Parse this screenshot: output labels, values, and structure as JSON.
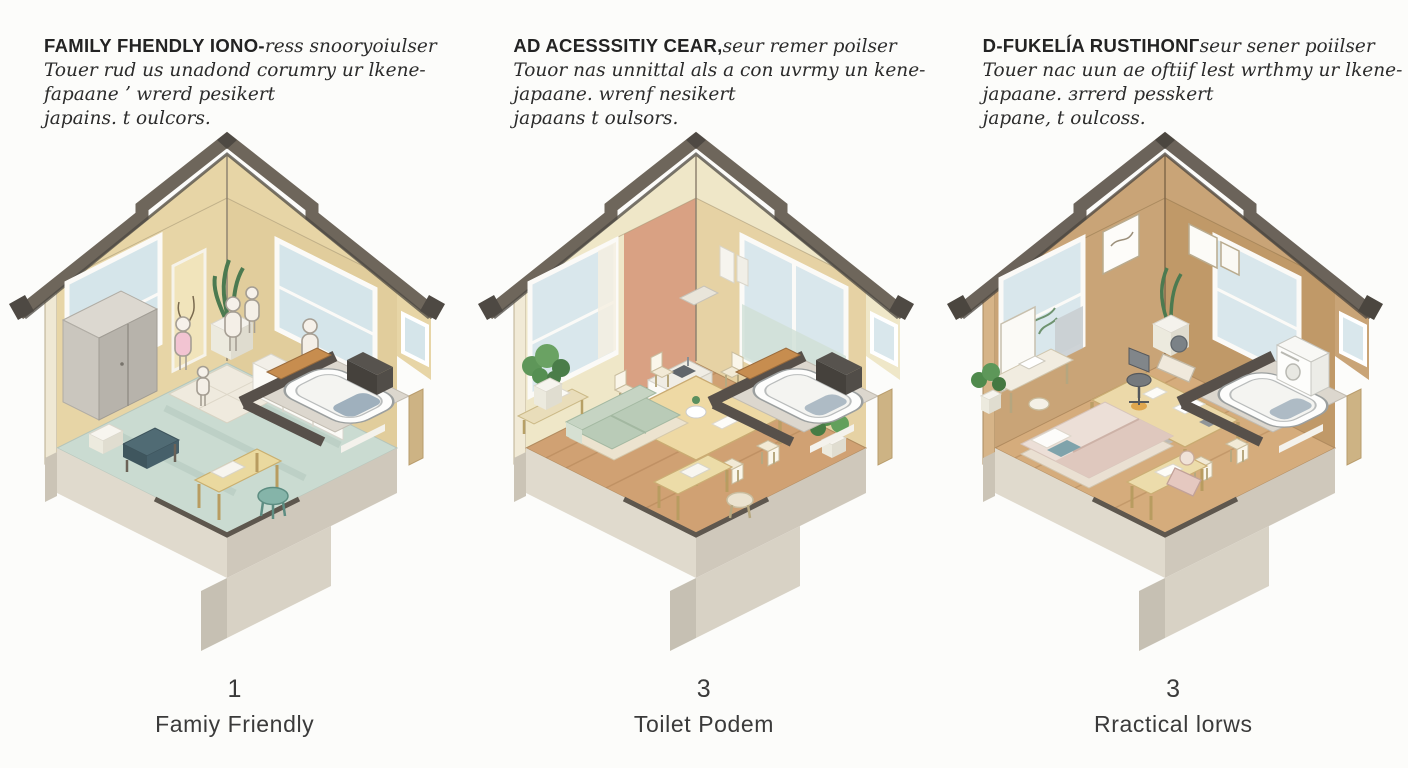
{
  "page": {
    "background": "#fcfcfa"
  },
  "panels": [
    {
      "heading_bold": "FAMILY FHENDLY IONO-",
      "heading_tail": "ress snooryoiulser",
      "line2": "Touer rud us unadond corumry ur lkene-",
      "line3": "fapaane ʼ wrerd pesikert",
      "line4": "japains. t oulcors.",
      "number": "1",
      "caption": "Famiy Friendly",
      "illustration": "isometric-cutaway-room-with-family-figures-teal-floor-bathtub",
      "colors": {
        "floor": "#cadbd1",
        "wallL": "#e7d5a6",
        "wallR": "#e1cd9c",
        "gable": "#e7d5a6",
        "roof": "#6e665b",
        "roofDark": "#4e4943",
        "sky": "#d5e5ea",
        "accent": "#f1e4bb"
      }
    },
    {
      "heading_bold": "AD ACESSSITIY CEAR,",
      "heading_tail": "seur remer poilser",
      "line2": "Touor nas unnittal als a con uvrmy un kene-",
      "line3": "japaane. wrenf nesikert",
      "line4": "japaans t oulsors.",
      "number": "3",
      "caption": "Toilet Podem",
      "illustration": "isometric-cutaway-room-with-dining-table-sofa-plants-bathtub",
      "colors": {
        "floor": "#d0a173",
        "wallL": "#efe7c8",
        "wallR": "#e6d2a4",
        "gable": "#efe7c8",
        "roof": "#6e665b",
        "roofDark": "#4e4943",
        "sky": "#d9e7ec",
        "accent": "#d9a183"
      }
    },
    {
      "heading_bold": "D-FUKELĺA RUSTIHONГ",
      "heading_tail": "seur sener poiilser",
      "line2": "Touer nac uun ae oftiif lest wrthmy ur lkene-",
      "line3": "japaane. зrrerd pesskert",
      "line4": "japane, t oulcoss.",
      "number": "3",
      "caption": "Rractical lorws",
      "illustration": "isometric-cutaway-room-with-bed-desk-dining-table-bathtub",
      "colors": {
        "floor": "#d5ac7c",
        "wallL": "#c9a477",
        "wallR": "#c09968",
        "gable": "#c9a477",
        "roof": "#6b635a",
        "roofDark": "#4b463f",
        "sky": "#d9e7ec",
        "accent": "#c9a477"
      }
    }
  ]
}
